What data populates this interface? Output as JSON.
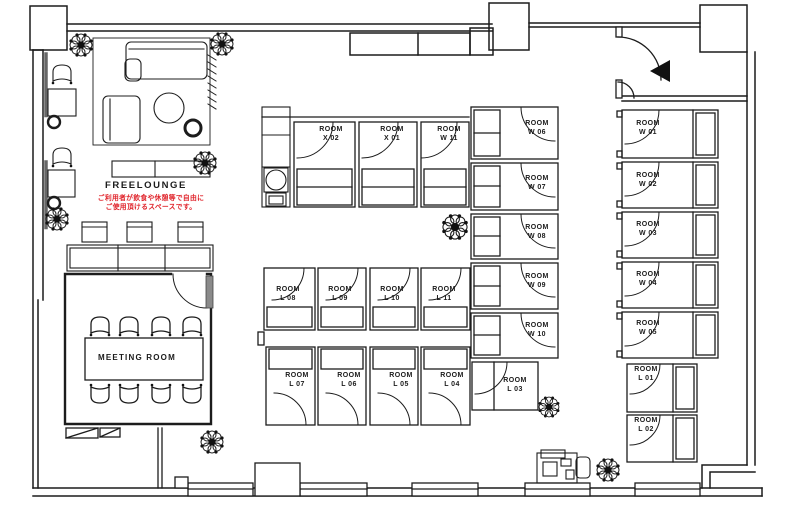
{
  "plan": {
    "type": "office-floor-plan"
  },
  "areas": {
    "freelounge": {
      "label": "FREELOUNGE",
      "note": "ご利用者が飲食や休憩等で自由に\nご使用頂けるスペースです。"
    },
    "meeting_room": {
      "label": "MEETING ROOM"
    }
  },
  "rooms": [
    {
      "id": "x02",
      "label": "ROOM\nX 02"
    },
    {
      "id": "x01",
      "label": "ROOM\nX 01"
    },
    {
      "id": "w11",
      "label": "ROOM\nW 11"
    },
    {
      "id": "w06",
      "label": "ROOM\nW 06"
    },
    {
      "id": "w07",
      "label": "ROOM\nW 07"
    },
    {
      "id": "w08",
      "label": "ROOM\nW 08"
    },
    {
      "id": "w09",
      "label": "ROOM\nW 09"
    },
    {
      "id": "w10",
      "label": "ROOM\nW 10"
    },
    {
      "id": "w01",
      "label": "ROOM\nW 01"
    },
    {
      "id": "w02",
      "label": "ROOM\nW 02"
    },
    {
      "id": "w03",
      "label": "ROOM\nW 03"
    },
    {
      "id": "w04",
      "label": "ROOM\nW 04"
    },
    {
      "id": "w05",
      "label": "ROOM\nW 05"
    },
    {
      "id": "l08",
      "label": "ROOM\nL 08"
    },
    {
      "id": "l09",
      "label": "ROOM\nL 09"
    },
    {
      "id": "l10",
      "label": "ROOM\nL 10"
    },
    {
      "id": "l11",
      "label": "ROOM\nL 11"
    },
    {
      "id": "l07",
      "label": "ROOM\nL 07"
    },
    {
      "id": "l06",
      "label": "ROOM\nL 06"
    },
    {
      "id": "l05",
      "label": "ROOM\nL 05"
    },
    {
      "id": "l04",
      "label": "ROOM\nL 04"
    },
    {
      "id": "l03",
      "label": "ROOM\nL 03"
    },
    {
      "id": "l01",
      "label": "ROOM\nL 01"
    },
    {
      "id": "l02",
      "label": "ROOM\nL 02"
    }
  ],
  "colors": {
    "line": "#1c1c1c",
    "note_red": "#e0242b",
    "background": "#ffffff"
  }
}
